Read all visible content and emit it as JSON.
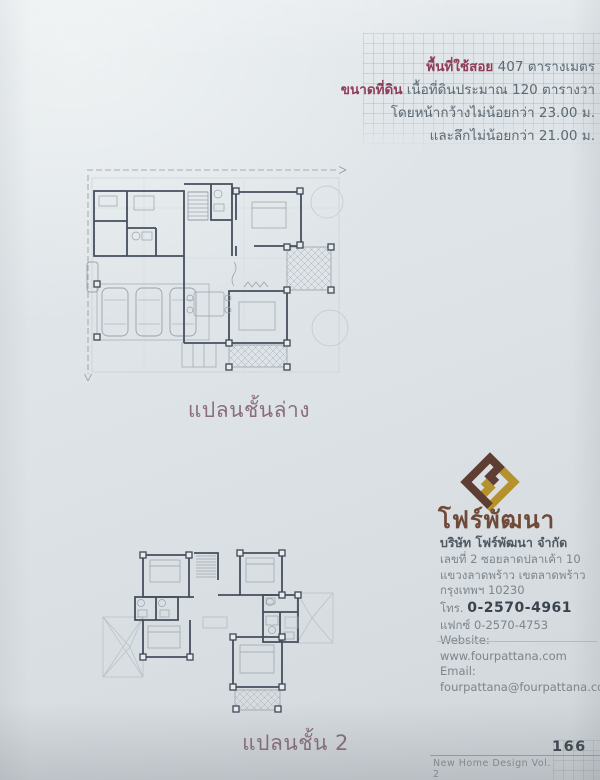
{
  "info_box": {
    "line1_label": "พื้นที่ใช้สอย",
    "line1_value": " 407 ตารางเมตร",
    "line2_label": "ขนาดที่ดิน",
    "line2_value": " เนื้อที่ดินประมาณ 120 ตารางวา",
    "line3": "โดยหน้ากว้างไม่น้อยกว่า 23.00 ม.",
    "line4": "และลึกไม่น้อยกว่า 21.00 ม."
  },
  "plans": {
    "ground_floor_label": "แปลนชั้นล่าง",
    "second_floor_label": "แปลนชั้น 2"
  },
  "company": {
    "logo_name": "โฟร์พัฒนา",
    "full_name": "บริษัท โฟร์พัฒนา จำกัด",
    "address": {
      "0": "เลขที่ 2 ซอยลาดปลาเค้า 10",
      "1": "แขวงลาดพร้าว เขตลาดพร้าว",
      "2": "กรุงเทพฯ 10230"
    },
    "phone_label": "โทร. ",
    "phone": "0-2570-4961",
    "fax_line": "แฟกซ์ 0-2570-4753",
    "website_line": "Website: www.fourpattana.com",
    "email_line": "Email: fourpattana@fourpattana.com"
  },
  "footer": {
    "book_title": "New Home Design Vol. 2",
    "page_number": "166"
  },
  "colors": {
    "accent_maroon": "#8e3d57",
    "plan_label_mauve": "#8b6d7d",
    "logo_gold": "#b5922e",
    "logo_brown": "#5e3d33",
    "wall_line": "#454f5d"
  }
}
